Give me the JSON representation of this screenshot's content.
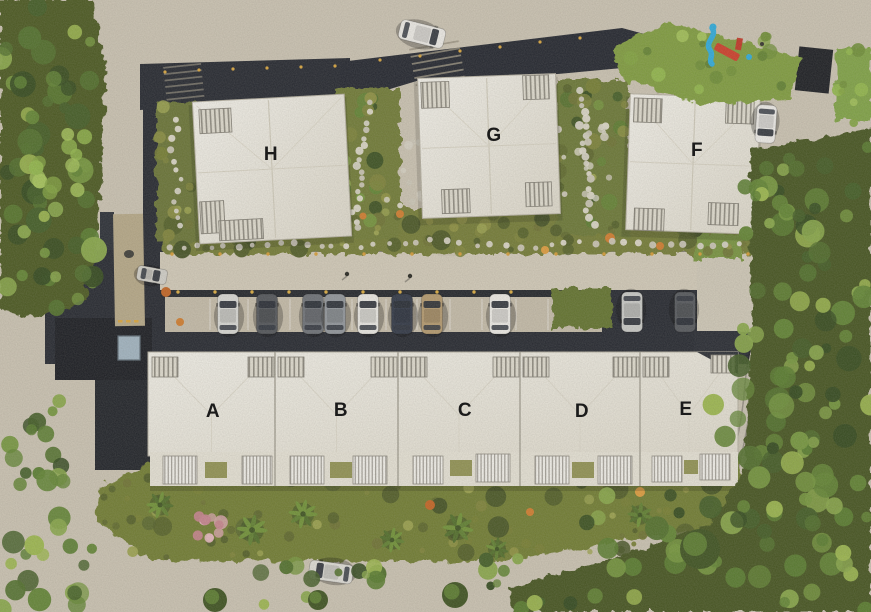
{
  "site_plan": {
    "type": "aerial-residential-site-plan",
    "buildings": [
      {
        "id": "A",
        "label": "A"
      },
      {
        "id": "B",
        "label": "B"
      },
      {
        "id": "C",
        "label": "C"
      },
      {
        "id": "D",
        "label": "D"
      },
      {
        "id": "E",
        "label": "E"
      },
      {
        "id": "F",
        "label": "F"
      },
      {
        "id": "G",
        "label": "G"
      },
      {
        "id": "H",
        "label": "H"
      }
    ],
    "colors": {
      "pavement": "#c9c1b0",
      "asphalt": "#20232b",
      "roof_white": "#ebe8de",
      "garden_olive": "#6e7a2f",
      "tree_green": "#4e6d28",
      "playground_slide_blue": "#2ba9da",
      "playground_frame_red": "#cc3a26",
      "label_text": "#1b1b1b"
    }
  }
}
